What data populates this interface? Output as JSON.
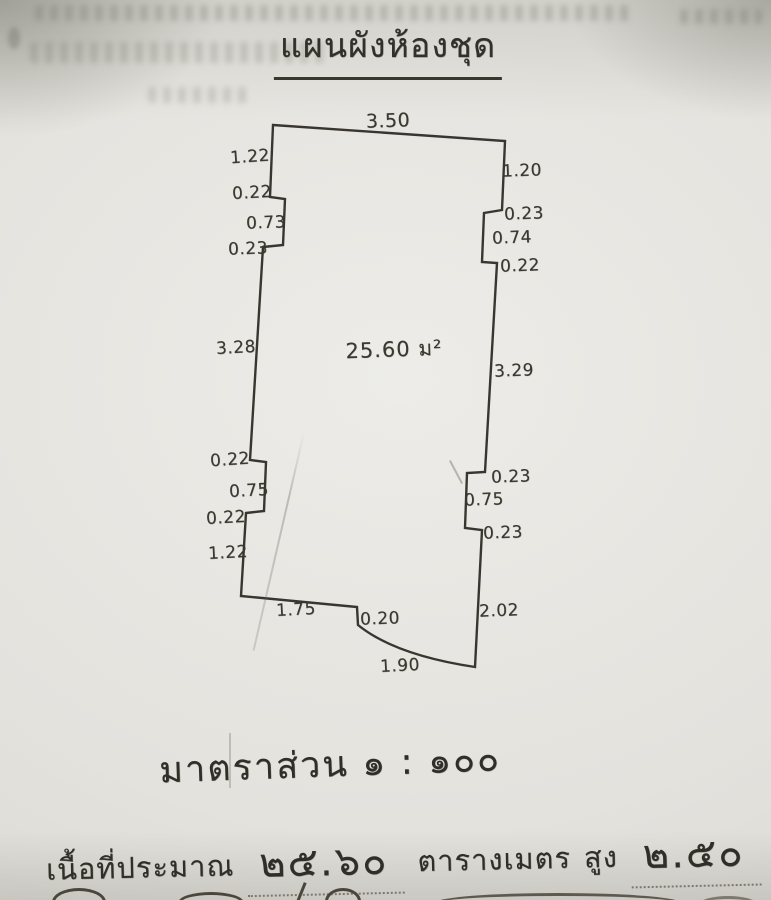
{
  "document": {
    "title": "แผนผังห้องชุด",
    "scale_line": "มาตราส่วน ๑ : ๑๐๐",
    "footer": {
      "area_prefix": "เนื้อที่ประมาณ",
      "area_value": "๒๕.๖๐",
      "area_unit": "ตารางเมตร",
      "height_prefix": "สูง",
      "height_value": "๒.๕๐",
      "height_unit": "เมตร"
    }
  },
  "plan": {
    "area_label": "25.60 ม²",
    "ink_color": "#3a362f",
    "paper_color": "#e4e2dd",
    "dimensions": {
      "top": "3.50",
      "left_upper_1": "1.22",
      "left_upper_2": "0.22",
      "left_upper_3": "0.73",
      "left_upper_4": "0.23",
      "left_middle": "3.28",
      "left_lower_1": "0.22",
      "left_lower_2": "0.75",
      "left_lower_3": "0.22",
      "left_lower_4": "1.22",
      "right_upper_1": "1.20",
      "right_upper_2": "0.23",
      "right_upper_3": "0.74",
      "right_upper_4": "0.22",
      "right_middle": "3.29",
      "right_lower_1": "0.23",
      "right_lower_2": "0.75",
      "right_lower_3": "0.23",
      "right_lower_4": "2.02",
      "bottom_left": "1.75",
      "bottom_step": "0.20",
      "bottom_curve": "1.90"
    }
  }
}
